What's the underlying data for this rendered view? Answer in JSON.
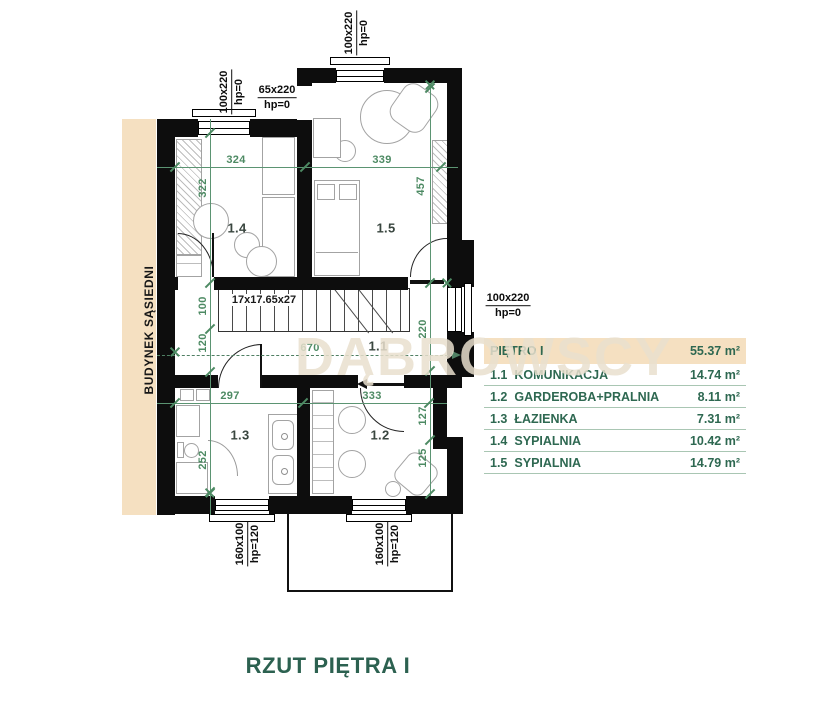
{
  "page": {
    "title": "RZUT PIĘTRA I",
    "neighbor_building_label": "BUDYNEK SĄSIEDNI",
    "watermark": "DĄBROWSCY"
  },
  "legend": {
    "header": {
      "name": "PIĘTRO I",
      "area": "55.37 m²"
    },
    "rows": [
      {
        "num": "1.1",
        "name": "KOMUNIKACJA",
        "area": "14.74 m²"
      },
      {
        "num": "1.2",
        "name": "GARDEROBA+PRALNIA",
        "area": "8.11 m²"
      },
      {
        "num": "1.3",
        "name": "ŁAZIENKA",
        "area": "7.31 m²"
      },
      {
        "num": "1.4",
        "name": "SYPIALNIA",
        "area": "10.42 m²"
      },
      {
        "num": "1.5",
        "name": "SYPIALNIA",
        "area": "14.79 m²"
      }
    ]
  },
  "rooms": {
    "r11": "1.1",
    "r12": "1.2",
    "r13": "1.3",
    "r14": "1.4",
    "r15": "1.5"
  },
  "dimensions": {
    "room14_width": "324",
    "room15_width": "339",
    "room14_depth": "322",
    "room15_depth": "457",
    "stair_width": "100",
    "hall_left": "120",
    "hall_right": "220",
    "hall_length": "670",
    "room13_width": "297",
    "room12_width": "333",
    "room13_depth": "252",
    "room12_depth_a": "127",
    "room12_depth_b": "125"
  },
  "stairs": {
    "label": "17x17.65x27"
  },
  "openings": {
    "top_window": {
      "size": "100x220",
      "hp": "hp=0"
    },
    "left_window": {
      "size": "100x220",
      "hp": "hp=0"
    },
    "door": {
      "size": "65x220",
      "hp": "hp=0"
    },
    "right_window": {
      "size": "100x220",
      "hp": "hp=0"
    },
    "bottom_window_a": {
      "size": "160x100",
      "hp": "hp=120"
    },
    "bottom_window_b": {
      "size": "160x100",
      "hp": "hp=120"
    }
  },
  "colors": {
    "dimension_green": "#4d8a63",
    "legend_green": "#2e6851",
    "beige": "#f5e0c1",
    "wall_black": "#0d0d0d"
  }
}
